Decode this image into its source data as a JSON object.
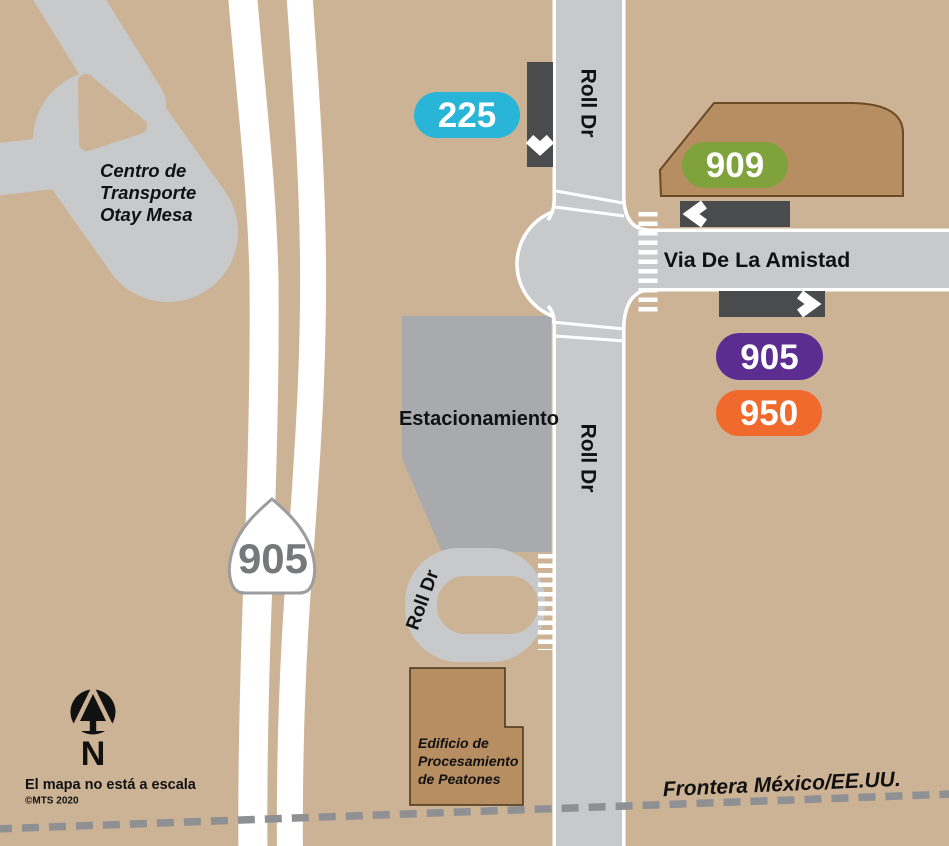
{
  "colors": {
    "background": "#ccb395",
    "road": "#c8c9cb",
    "road_edge": "#ffffff",
    "parking_area": "#a8aaad",
    "transit_center_area": "#c8c9cb",
    "building_fill": "#b78e61",
    "building_outline_top": "#6b4a24",
    "building_outline_bottom": "#46341a",
    "stop_bar": "#4a4b4d",
    "border_dash": "#8f9093",
    "shield_text": "#77787a"
  },
  "routes": {
    "r225": {
      "number": "225",
      "color": "#29b5d8"
    },
    "r909": {
      "number": "909",
      "color": "#7fa23c"
    },
    "r905": {
      "number": "905",
      "color": "#5c2d91"
    },
    "r950": {
      "number": "950",
      "color": "#f16a2d"
    }
  },
  "highway": {
    "number": "905"
  },
  "streets": {
    "roll_dr": "Roll Dr",
    "via_de_la_amistad": "Via De La Amistad"
  },
  "places": {
    "transit_center_lines": [
      "Centro de",
      "Transporte",
      "Otay Mesa"
    ],
    "parking": "Estacionamiento",
    "pedestrian_building_lines": [
      "Edificio de",
      "Procesamiento",
      "de Peatones"
    ]
  },
  "border": {
    "label": "Frontera México/EE.UU."
  },
  "compass": {
    "label": "N"
  },
  "notes": {
    "scale": "El mapa no está a escala",
    "copyright": "©MTS 2020"
  }
}
